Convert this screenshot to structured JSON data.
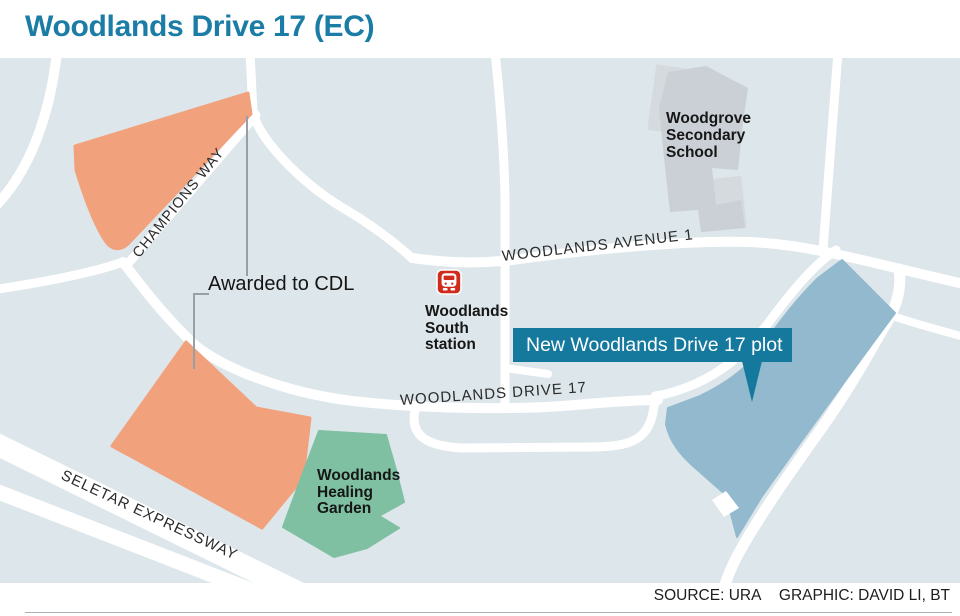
{
  "title": "Woodlands Drive 17 (EC)",
  "map": {
    "labels": {
      "champions_way": "CHAMPIONS WAY",
      "woodlands_avenue_1": "WOODLANDS AVENUE 1",
      "woodlands_drive_17": "WOODLANDS DRIVE 17",
      "seletar_expressway": "SELETAR EXPRESSWAY",
      "awarded": "Awarded to CDL",
      "station": "Woodlands\nSouth\nstation",
      "school": "Woodgrove\nSecondary\nSchool",
      "garden": "Woodlands\nHealing\nGarden",
      "callout": "New Woodlands Drive 17 plot"
    },
    "colors": {
      "title_teal": "#1b7ca6",
      "map_background": "#dde6ea",
      "road_white": "#ffffff",
      "plot_orange": "#f1a17b",
      "plot_blue": "#92b9ce",
      "garden_green": "#7fc0a2",
      "school_gray": "#cad0d6",
      "school_gray_light": "#d5dadf",
      "callout_teal": "#15799e",
      "mrt_red": "#d02b1c"
    }
  },
  "source": {
    "source_label": "SOURCE: URA",
    "graphic_label": "GRAPHIC: DAVID LI, BT"
  }
}
